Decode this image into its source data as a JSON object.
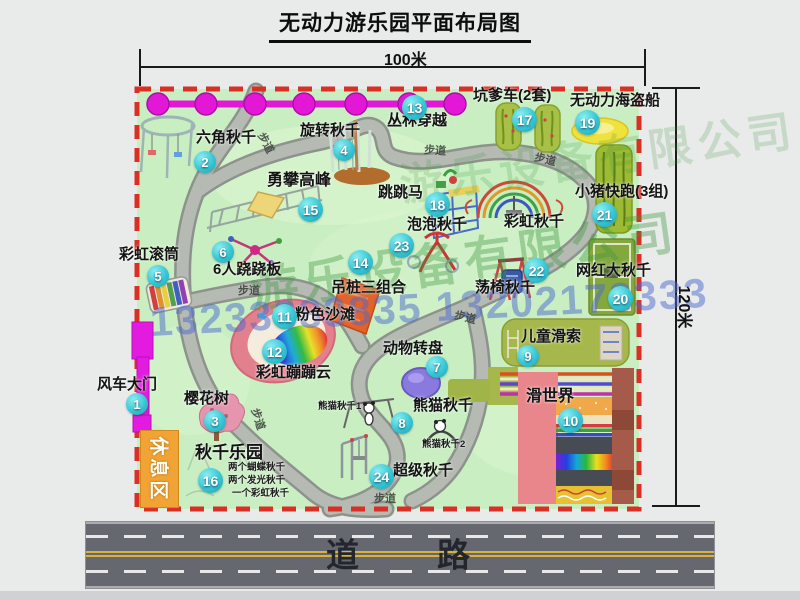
{
  "title": "无动力游乐园平面布局图",
  "dimensions": {
    "width_label": "100米",
    "height_label": "120米"
  },
  "road": {
    "label": "道　　路"
  },
  "watermark": {
    "company": "游乐设备有限公司",
    "phones": "13233883835 13202178333"
  },
  "park": {
    "rest_area_label": "休息区",
    "path_label": "步道",
    "rainbow_swing_label": "彩虹秋千",
    "panda_sub_labels": [
      "熊猫秋千1",
      "熊猫秋千2"
    ],
    "swing_park_notes": [
      "两个蝴蝶秋千",
      "两个发光秋千",
      "一个彩虹秋千"
    ]
  },
  "attractions": [
    {
      "num": "1",
      "name": "风车大门"
    },
    {
      "num": "2",
      "name": "六角秋千"
    },
    {
      "num": "3",
      "name": "樱花树"
    },
    {
      "num": "4",
      "name": "旋转秋千"
    },
    {
      "num": "5",
      "name": "彩虹滚筒"
    },
    {
      "num": "6",
      "name": "6人跷跷板"
    },
    {
      "num": "7",
      "name": "动物转盘"
    },
    {
      "num": "8",
      "name": "熊猫秋千"
    },
    {
      "num": "9",
      "name": "儿童滑索"
    },
    {
      "num": "10",
      "name": "滑世界"
    },
    {
      "num": "11",
      "name": "粉色沙滩"
    },
    {
      "num": "12",
      "name": "彩虹蹦蹦云"
    },
    {
      "num": "13",
      "name": "丛林穿越"
    },
    {
      "num": "14",
      "name": "吊桩三组合"
    },
    {
      "num": "15",
      "name": "勇攀高峰"
    },
    {
      "num": "16",
      "name": "秋千乐园"
    },
    {
      "num": "17",
      "name": "坑爹车(2套)"
    },
    {
      "num": "18",
      "name": "跳跳马"
    },
    {
      "num": "19",
      "name": "无动力海盗船"
    },
    {
      "num": "20",
      "name": "网红大秋千"
    },
    {
      "num": "21",
      "name": "小猪快跑(3组)"
    },
    {
      "num": "22",
      "name": "荡椅秋千"
    },
    {
      "num": "23",
      "name": "泡泡秋千"
    },
    {
      "num": "24",
      "name": "超级秋千"
    }
  ],
  "colors": {
    "park_green": "#c9eec2",
    "border_red": "#d92f25",
    "badge_teal": "#38c6d4",
    "accent_magenta": "#e318d6",
    "road_gray": "#65686e"
  }
}
